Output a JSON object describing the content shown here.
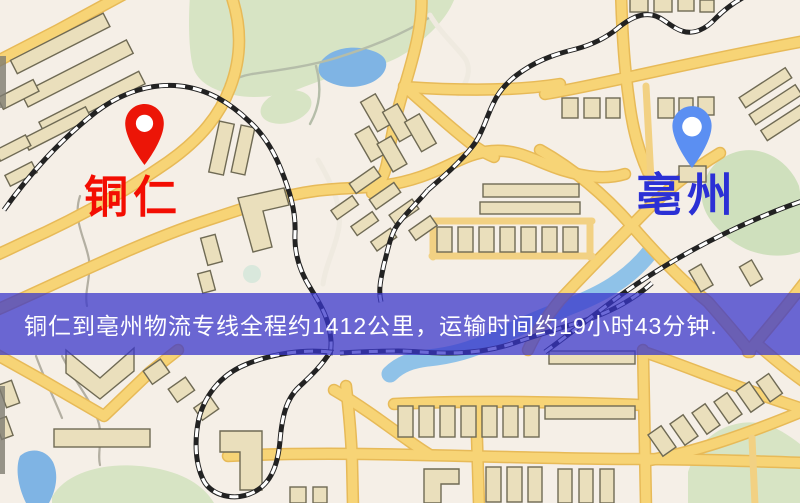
{
  "map": {
    "origin": {
      "label": "铜仁"
    },
    "destination": {
      "label": "亳州"
    },
    "banner_text": "铜仁到亳州物流专线全程约1412公里，运输时间约19小时43分钟.",
    "route": {
      "distance_km": "1412",
      "duration_hours": "19",
      "duration_minutes": "43"
    }
  },
  "colors": {
    "origin_pin": "#ec1507",
    "origin_label": "#f30d02",
    "destination_pin": "#5b8ff2",
    "destination_label": "#2b30d5",
    "banner_background": "#3836ca",
    "banner_text": "#ffffff",
    "road": "#f7d476",
    "water": "#7fb4e4",
    "park": "#d7e4c4",
    "building": "#eadfbc"
  }
}
